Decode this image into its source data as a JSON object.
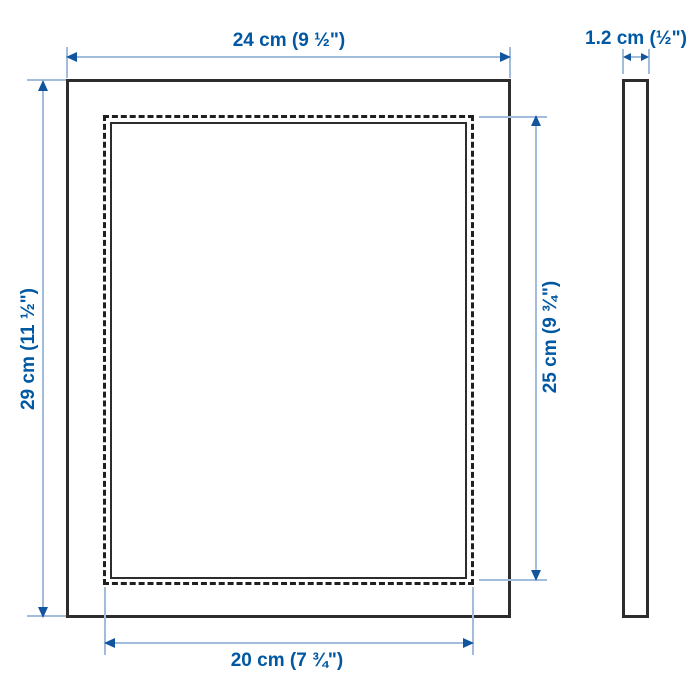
{
  "diagram": {
    "type": "product-dimension-drawing",
    "views": {
      "front": "frame front view with dashed picture-area outline",
      "side": "thin side profile"
    },
    "dimensions": {
      "outer_width": {
        "label": "24 cm (9 ½\")",
        "cm": 24
      },
      "outer_height": {
        "label": "29 cm (11 ½\")",
        "cm": 29
      },
      "inner_height": {
        "label": "25 cm (9 ¾\")",
        "cm": 25
      },
      "inner_width": {
        "label": "20 cm (7 ¾\")",
        "cm": 20
      },
      "thickness": {
        "label": "1.2 cm (½\")",
        "cm": 1.2
      }
    },
    "colors": {
      "label_text": "#0058a3",
      "dimension_line": "#a3bcdb",
      "arrowhead": "#11559f",
      "outline": "#2d2d2d",
      "background": "#ffffff"
    }
  }
}
